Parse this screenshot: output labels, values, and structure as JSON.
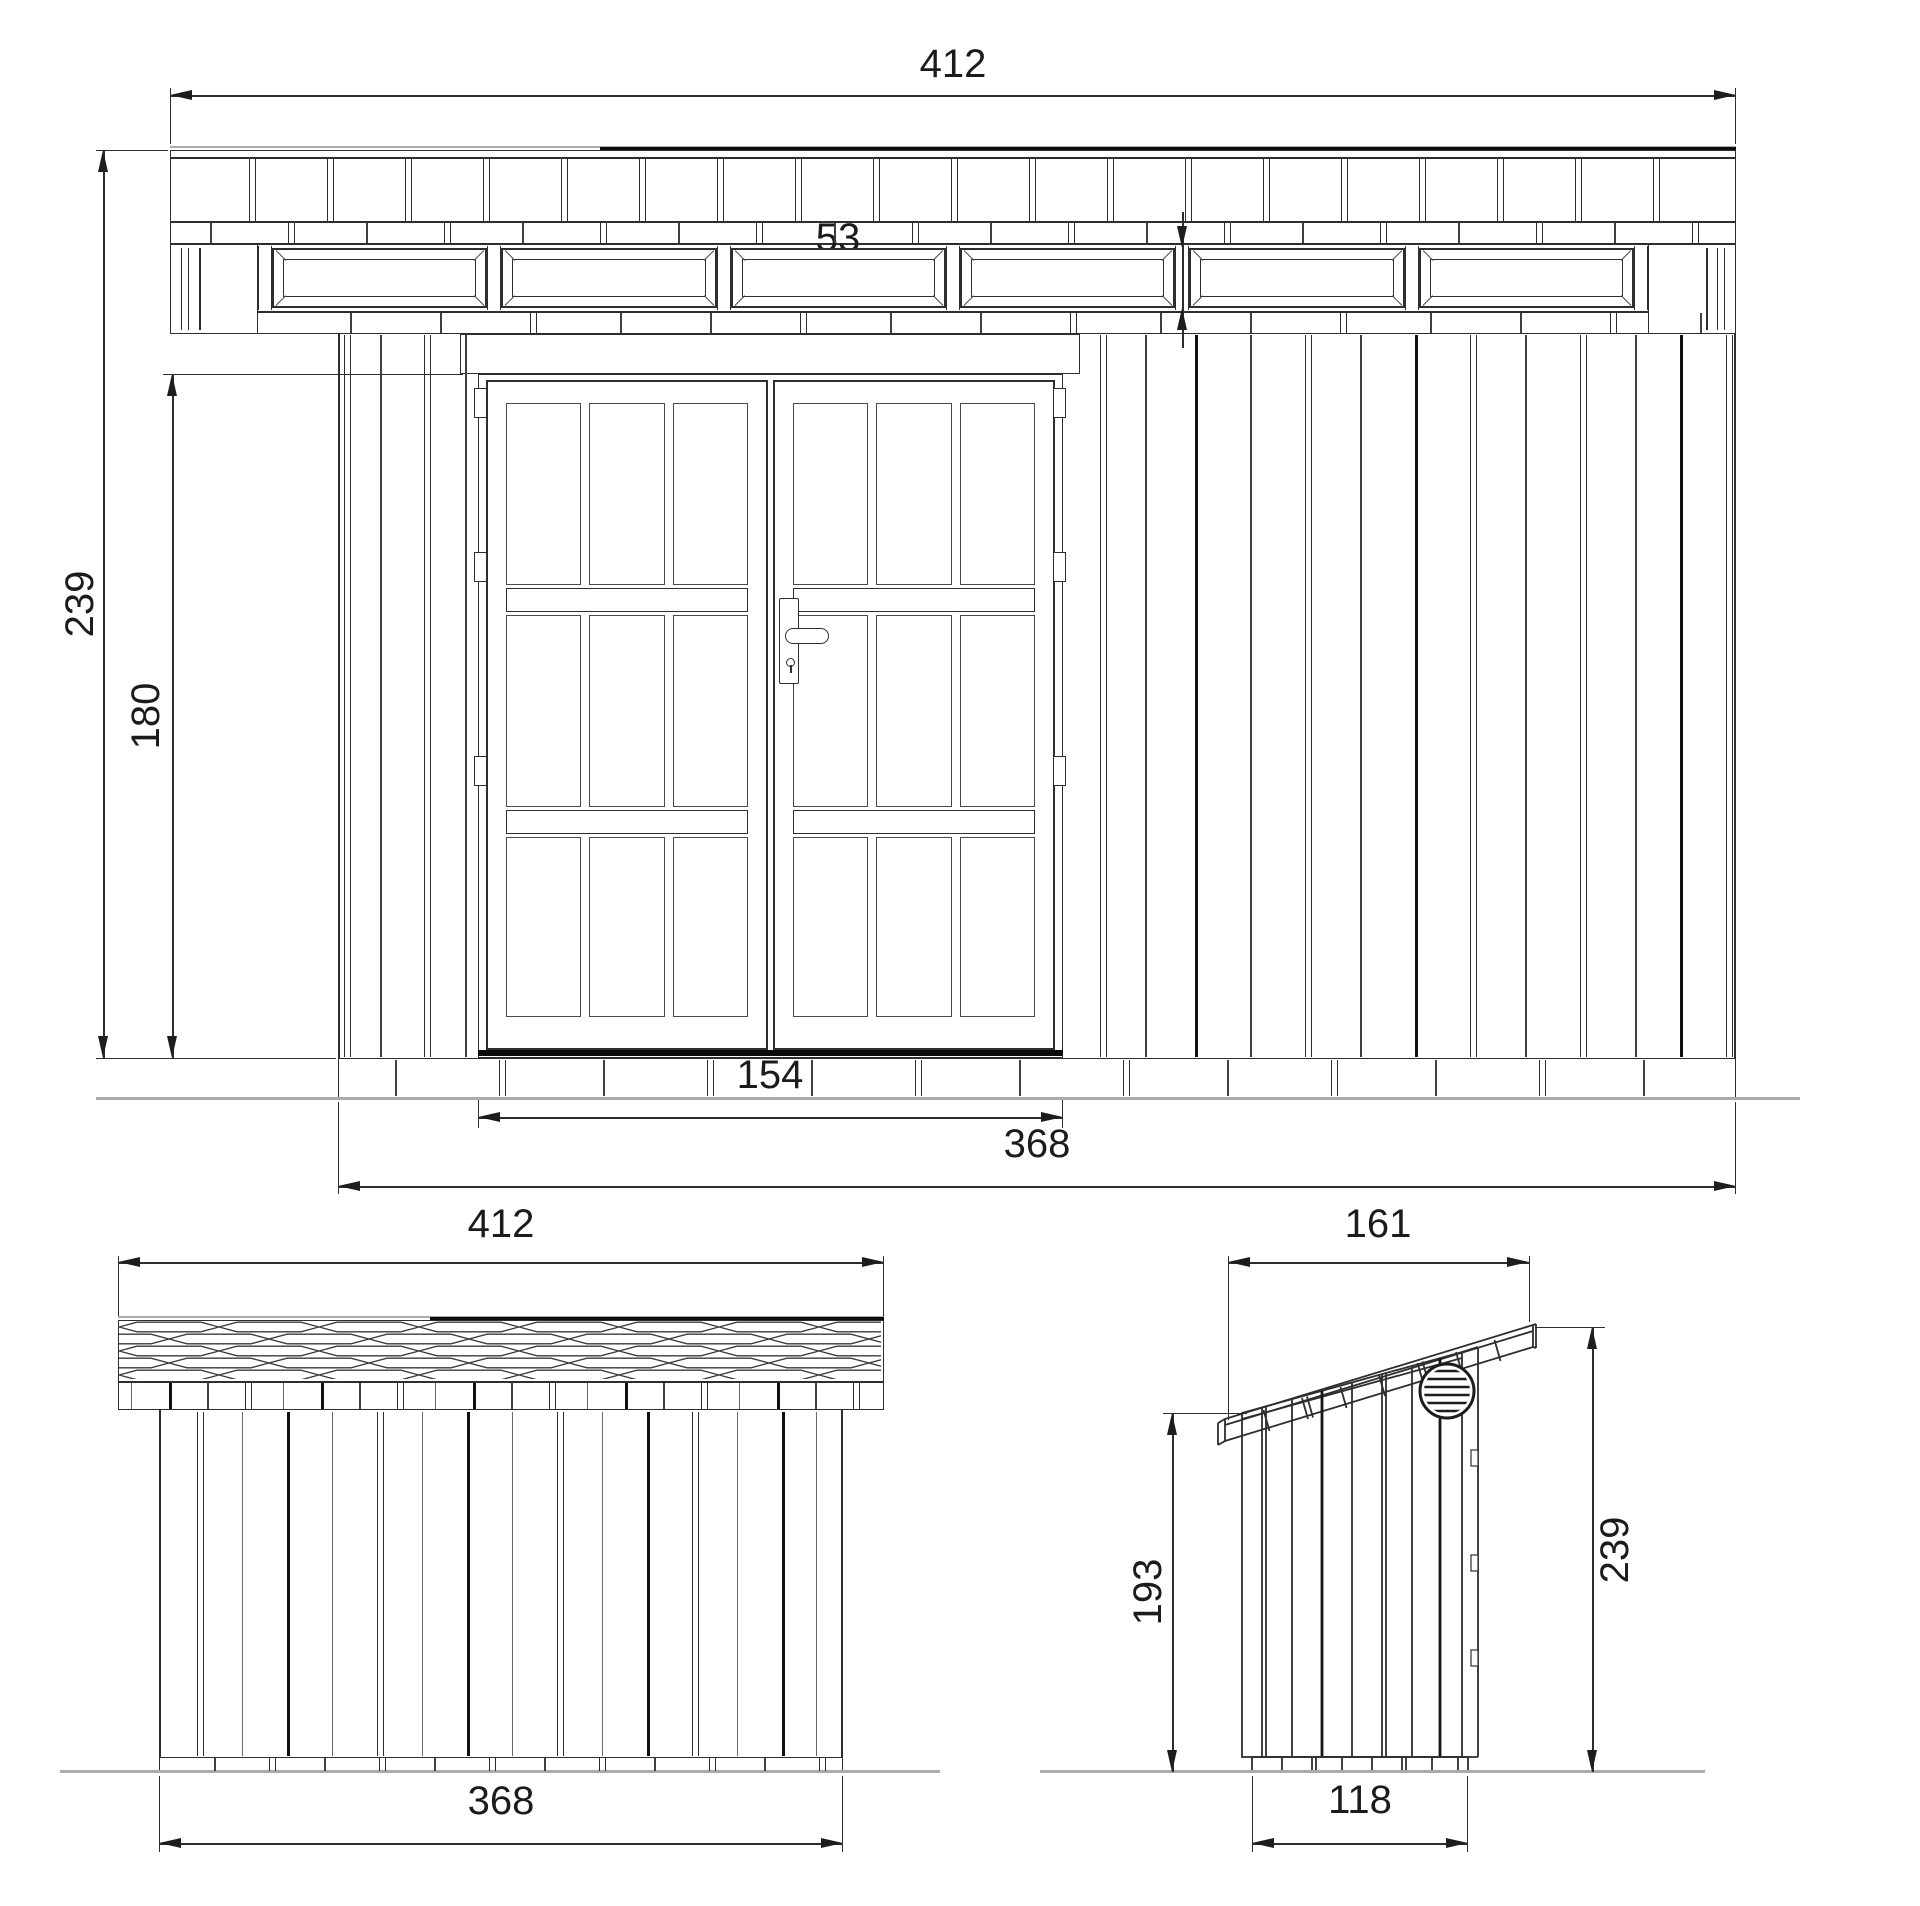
{
  "front_view": {
    "dims": {
      "roof_width": "412",
      "window_width": "53",
      "transom_height": "14",
      "total_height": "239",
      "door_height": "180",
      "door_width": "154",
      "wall_width": "368"
    }
  },
  "back_view": {
    "dims": {
      "roof_width": "412",
      "wall_width": "368"
    }
  },
  "side_view": {
    "dims": {
      "roof_depth": "161",
      "rear_height": "193",
      "total_height": "239",
      "wall_depth": "118"
    }
  },
  "colors": {
    "line": "#2e2e2e",
    "accent_dark": "#0c0c0c",
    "ground": "#ababab",
    "background": "#ffffff"
  }
}
